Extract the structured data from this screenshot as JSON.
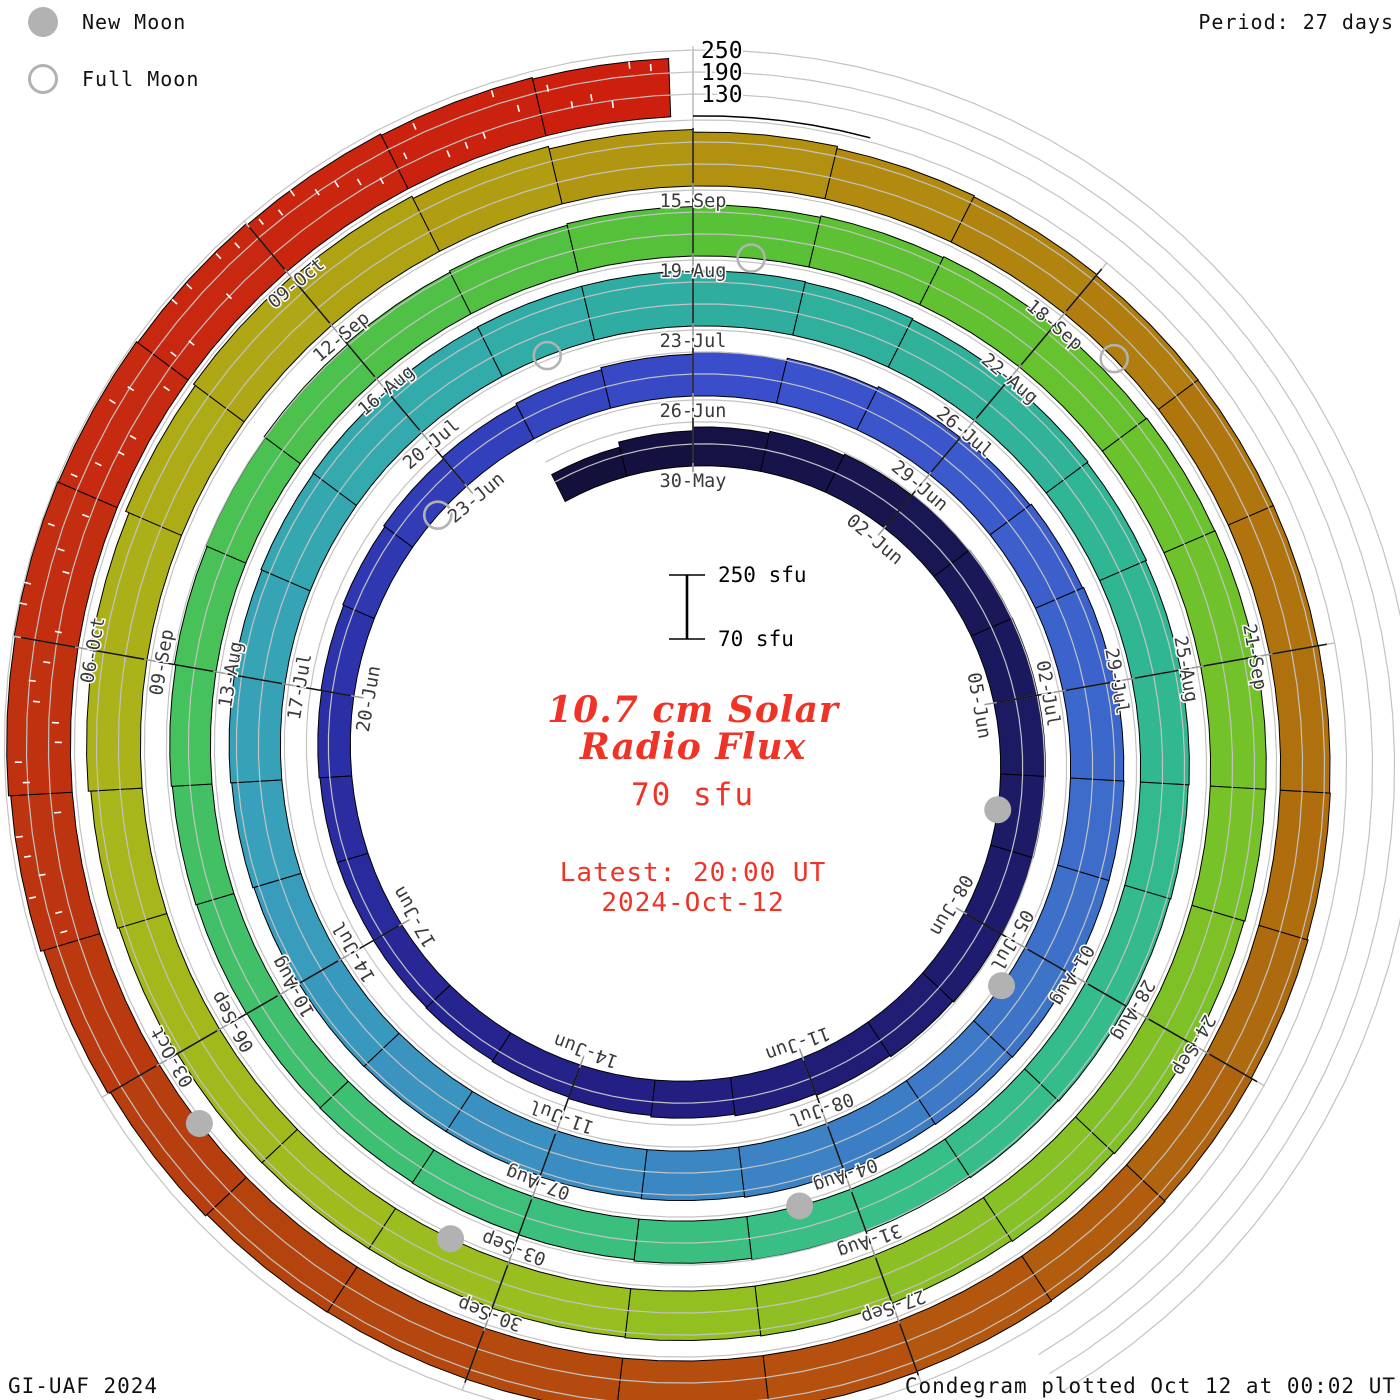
{
  "legend": {
    "new_moon_label": "New Moon",
    "full_moon_label": "Full Moon"
  },
  "header": {
    "period_label": "Period: 27 days"
  },
  "footer": {
    "credit": "GI-UAF 2024",
    "plotted": "Condegram plotted Oct 12 at 00:02 UT"
  },
  "center_text": {
    "title_line1": "10.7 cm Solar",
    "title_line2": "Radio Flux",
    "current_flux": "70 sfu",
    "latest_line1": "Latest: 20:00 UT",
    "latest_line2": "2024-Oct-12"
  },
  "scale_bar": {
    "top_label": "250 sfu",
    "bottom_label": "70 sfu"
  },
  "radial_axis": {
    "tick_labels": [
      "250",
      "190",
      "130"
    ],
    "tick_values": [
      250,
      190,
      130
    ]
  },
  "colors": {
    "title_red": "#ef3327",
    "moon_gray": "#b2b2b2",
    "grid_gray": "#c3c3c3",
    "tick_gray": "#9a9a9a",
    "label_gray": "#3a3a3a",
    "bar_outline": "#000000",
    "background": "#ffffff"
  },
  "chart_data": {
    "type": "spiral-bar-condegram",
    "title": "10.7 cm Solar Radio Flux",
    "units": "sfu",
    "period_days": 27,
    "start_date": "2024-05-28",
    "end_date": "2024-10-11",
    "flux_axis": {
      "min": 70,
      "max": 250,
      "gridlines": [
        130,
        190,
        250
      ]
    },
    "turn_start_labels": [
      "30-May",
      "26-Jun",
      "23-Jul",
      "19-Aug",
      "15-Sep"
    ],
    "date_tick_labels": [
      "30-May",
      "02-Jun",
      "05-Jun",
      "08-Jun",
      "11-Jun",
      "14-Jun",
      "17-Jun",
      "20-Jun",
      "23-Jun",
      "26-Jun",
      "29-Jun",
      "02-Jul",
      "05-Jul",
      "08-Jul",
      "11-Jul",
      "14-Jul",
      "17-Jul",
      "20-Jul",
      "23-Jul",
      "26-Jul",
      "29-Jul",
      "01-Aug",
      "04-Aug",
      "07-Aug",
      "10-Aug",
      "13-Aug",
      "16-Aug",
      "19-Aug",
      "22-Aug",
      "25-Aug",
      "28-Aug",
      "31-Aug",
      "03-Sep",
      "06-Sep",
      "09-Sep",
      "12-Sep",
      "15-Sep",
      "18-Sep",
      "21-Sep",
      "24-Sep",
      "27-Sep",
      "30-Sep",
      "03-Oct",
      "06-Oct",
      "09-Oct"
    ],
    "daily_flux_sfu": [
      152,
      166,
      176,
      182,
      186,
      189,
      191,
      192,
      192,
      191,
      189,
      186,
      183,
      179,
      175,
      171,
      167,
      163,
      160,
      158,
      157,
      157,
      159,
      161,
      164,
      168,
      173,
      178,
      184,
      190,
      196,
      201,
      206,
      210,
      213,
      215,
      216,
      216,
      215,
      213,
      211,
      208,
      205,
      203,
      201,
      201,
      202,
      204,
      207,
      210,
      213,
      216,
      218,
      220,
      221,
      221,
      220,
      218,
      215,
      212,
      209,
      206,
      203,
      201,
      199,
      198,
      196,
      193,
      189,
      185,
      181,
      178,
      176,
      175,
      176,
      178,
      181,
      185,
      189,
      193,
      197,
      201,
      205,
      209,
      213,
      216,
      219,
      221,
      222,
      222,
      221,
      219,
      216,
      213,
      210,
      207,
      205,
      203,
      202,
      202,
      203,
      206,
      210,
      217,
      226,
      236,
      242,
      238,
      231,
      224,
      217,
      211,
      208,
      205,
      204,
      204,
      205,
      207,
      210,
      213,
      215,
      217,
      218,
      218,
      218,
      217,
      218,
      223,
      230,
      238,
      244,
      247,
      245,
      241,
      237,
      233,
      229
    ],
    "new_moons": [
      {
        "date": "2024-06-06",
        "day_index": 9
      },
      {
        "date": "2024-07-05",
        "day_index": 38
      },
      {
        "date": "2024-08-04",
        "day_index": 68
      },
      {
        "date": "2024-09-03",
        "day_index": 98
      },
      {
        "date": "2024-10-02",
        "day_index": 127
      }
    ],
    "full_moons": [
      {
        "date": "2024-06-22",
        "day_index": 25
      },
      {
        "date": "2024-07-21",
        "day_index": 54
      },
      {
        "date": "2024-08-19",
        "day_index": 83
      },
      {
        "date": "2024-09-18",
        "day_index": 113
      }
    ],
    "overscale_tick_day_indices": [
      129,
      130,
      131,
      132,
      133,
      134,
      135,
      136
    ],
    "colormap_stops": [
      [
        0,
        "#13103c"
      ],
      [
        8,
        "#1c1a62"
      ],
      [
        16,
        "#241f84"
      ],
      [
        22,
        "#2b2fa6"
      ],
      [
        26,
        "#3340bb"
      ],
      [
        29,
        "#3a4ecb"
      ],
      [
        34,
        "#3c63cc"
      ],
      [
        38,
        "#3d74c8"
      ],
      [
        43,
        "#3b8cc2"
      ],
      [
        48,
        "#38a0ba"
      ],
      [
        53,
        "#33abab"
      ],
      [
        56,
        "#2fae9f"
      ],
      [
        62,
        "#31b890"
      ],
      [
        68,
        "#39bf85"
      ],
      [
        73,
        "#3fc06e"
      ],
      [
        78,
        "#49c153"
      ],
      [
        83,
        "#58c135"
      ],
      [
        88,
        "#6fc22b"
      ],
      [
        93,
        "#86c125"
      ],
      [
        98,
        "#9cbd1f"
      ],
      [
        103,
        "#aab41a"
      ],
      [
        107,
        "#b0a313"
      ],
      [
        110,
        "#b29110"
      ],
      [
        114,
        "#b0760e"
      ],
      [
        118,
        "#ae6a0e"
      ],
      [
        122,
        "#b5500e"
      ],
      [
        126,
        "#b4430e"
      ],
      [
        129,
        "#bd3410"
      ],
      [
        132,
        "#c62a10"
      ],
      [
        136,
        "#cc1f0e"
      ]
    ]
  }
}
